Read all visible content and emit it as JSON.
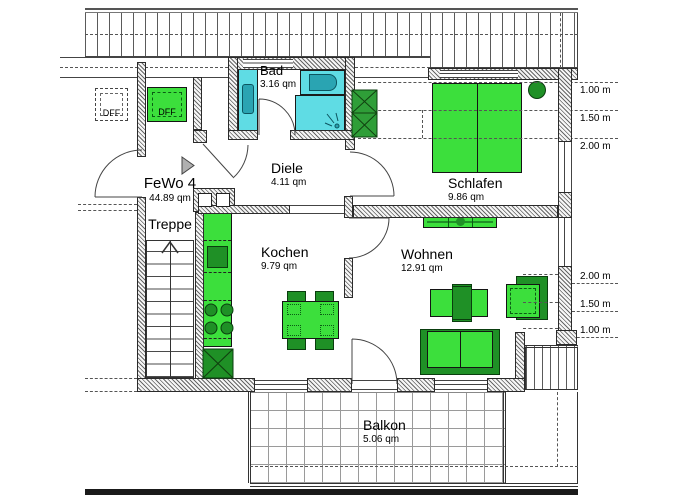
{
  "unit": {
    "label": "FeWo 4",
    "area": "44.89 qm"
  },
  "rooms": {
    "bad": {
      "name": "Bad",
      "area": "3.16 qm"
    },
    "diele": {
      "name": "Diele",
      "area": "4.11 qm"
    },
    "schlafen": {
      "name": "Schlafen",
      "area": "9.86 qm"
    },
    "kochen": {
      "name": "Kochen",
      "area": "9.79 qm"
    },
    "wohnen": {
      "name": "Wohnen",
      "area": "12.91 qm"
    },
    "balkon": {
      "name": "Balkon",
      "area": "5.06 qm"
    },
    "treppe": {
      "name": "Treppe"
    }
  },
  "roof_windows": {
    "left": "DFF",
    "right": "DFF"
  },
  "measurements": {
    "top": [
      "1.00 m",
      "1.50 m",
      "2.00 m"
    ],
    "bottom": [
      "2.00 m",
      "1.50 m",
      "1.00 m"
    ]
  },
  "colors": {
    "furniture_green": "#3cdf3c",
    "furniture_green_dark": "#1f9026",
    "wardrobe_green": "#2f9e38",
    "sanitary_cyan": "#5fdce4",
    "sanitary_teal": "#2aa4b2"
  }
}
